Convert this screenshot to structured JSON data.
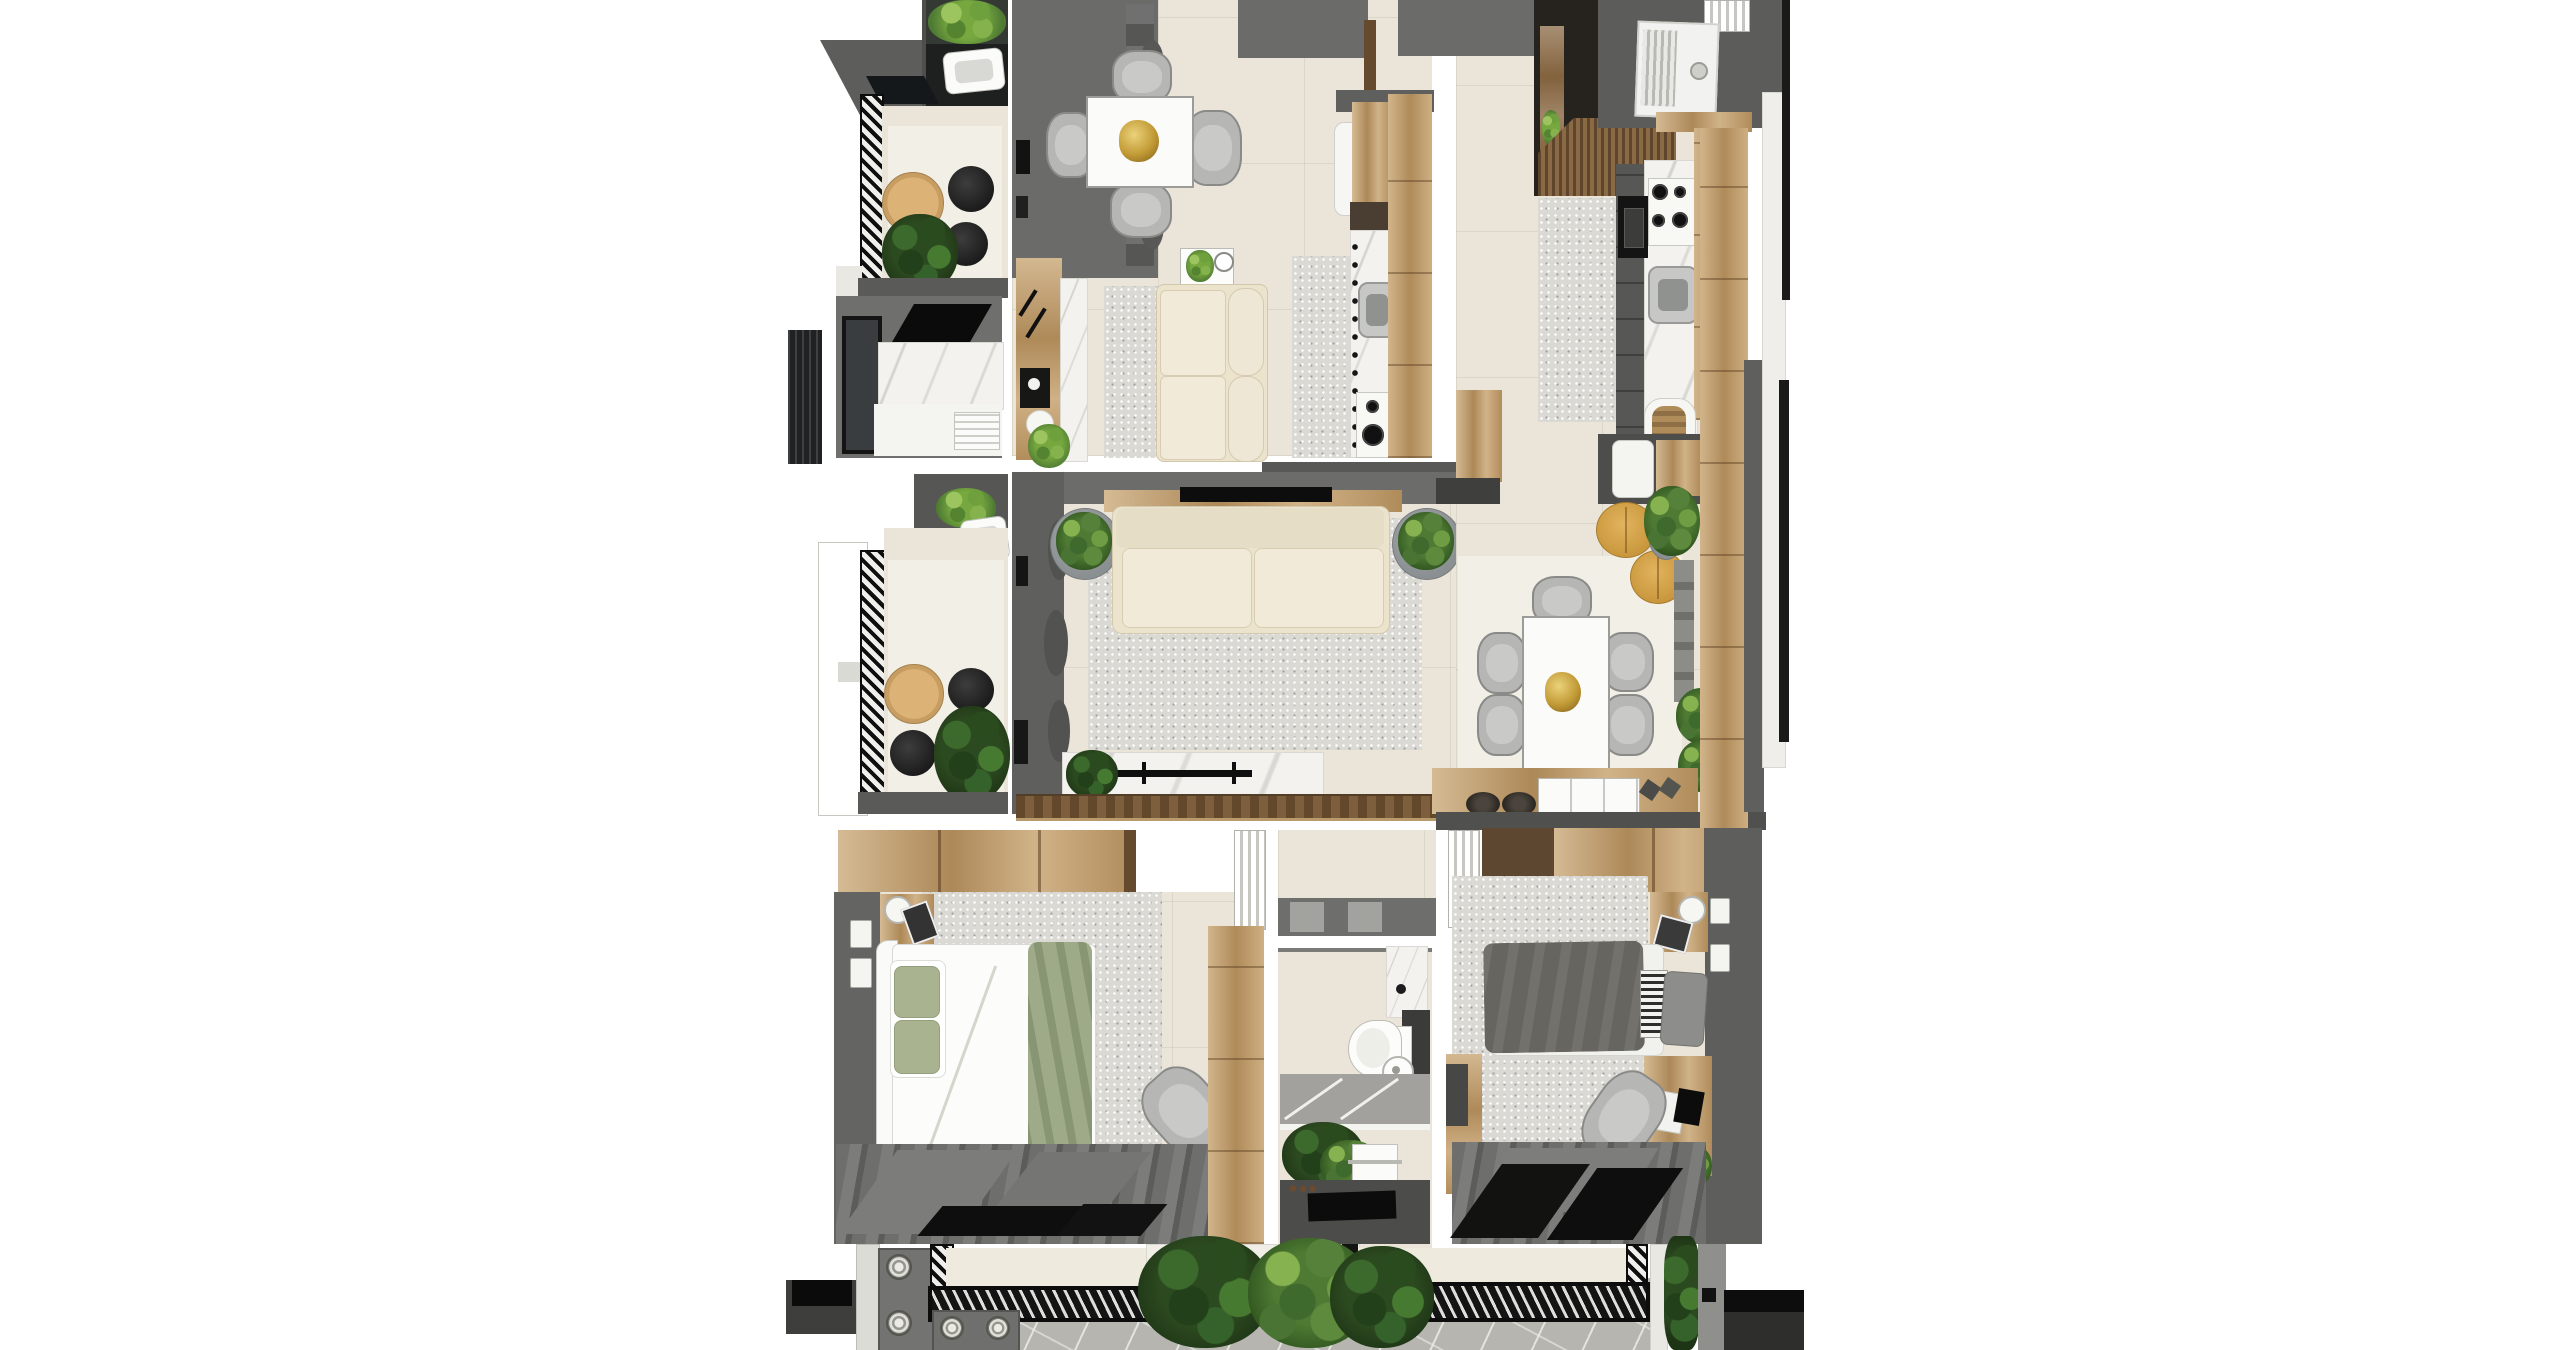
{
  "scene": {
    "type": "apartment floor plan - top-down 3D render",
    "view": "top-down",
    "has_text": false,
    "background": "#ffffff"
  },
  "palette": {
    "wall": "#6b6b69",
    "wallDark": "#535351",
    "wallDeep": "#3f3f3d",
    "floor": "#eae5d8",
    "floorLight": "#f2efe6",
    "rug": "#dad9d4",
    "wood": "#c5a06b",
    "woodDark": "#8a6a45",
    "woodDeep": "#654a2e",
    "marble": "#f3f2ee",
    "cream": "#ece3cd",
    "sage": "#a9b390",
    "duvet": "#67655f",
    "chair": "#b6b6b4",
    "gold": "#c49f3f",
    "mustard": "#d8a74e",
    "leaf": "#4e7a33",
    "leafDark": "#2c4a20",
    "stone": "#b6b5b0",
    "charcoal": "#131312"
  },
  "rooms": [
    {
      "name": "balcony-top-left",
      "furniture": [
        "planter",
        "outdoor-sink",
        "round-wood-table",
        "black-stools",
        "plant",
        "hatched-railing"
      ]
    },
    {
      "name": "laundry-room",
      "furniture": [
        "door",
        "marble-wall",
        "washer-counter",
        "ceiling-hatch",
        "ac-panel"
      ]
    },
    {
      "name": "balcony-middle-left",
      "furniture": [
        "white-door",
        "hatched-railing",
        "round-wood-table",
        "black-stools",
        "plant",
        "outdoor-sink"
      ]
    },
    {
      "name": "living-dining-a",
      "furniture": [
        "gray-wardrobe",
        "square-dining-table",
        "gold-bowl",
        "four-chairs",
        "coffee-table",
        "cream-sofa",
        "runner-rugs",
        "coffee-counter",
        "espresso-machine"
      ]
    },
    {
      "name": "kitchen-a",
      "furniture": [
        "fridge",
        "wood-cabinet",
        "marble-counter",
        "sink",
        "two-burner-stove",
        "wood-counter"
      ]
    },
    {
      "name": "living-room",
      "furniture": [
        "tv-wall-cabinet",
        "tv-console",
        "tv",
        "cream-sofa",
        "area-rug",
        "plant-pots",
        "marble-console",
        "towel-rail",
        "wood-deck"
      ]
    },
    {
      "name": "entry-hall-b",
      "furniture": [
        "dark-doorway",
        "wood-door",
        "slatted-awning",
        "washer-door",
        "wood-shelf"
      ]
    },
    {
      "name": "kitchen-b",
      "furniture": [
        "four-burner-stove",
        "microwave",
        "sink",
        "marble-counter",
        "wood-cabinet",
        "bread-box",
        "island-fridge",
        "rug"
      ]
    },
    {
      "name": "dining-b",
      "furniture": [
        "rect-dining-table",
        "gold-bowl",
        "five-chairs",
        "mustard-poufs",
        "plants",
        "sideboard",
        "white-drawers",
        "baskets"
      ]
    },
    {
      "name": "bedroom-left",
      "furniture": [
        "wood-wardrobe",
        "double-bed",
        "sage-pillows",
        "sage-throw",
        "nightstands",
        "lamp",
        "rug",
        "armchair",
        "plant",
        "dark-curtains",
        "louver-door",
        "tall-wardrobe"
      ]
    },
    {
      "name": "hallway-bath",
      "furniture": [
        "thresholds",
        "marble-shelf",
        "vanity",
        "toilet",
        "round-sink",
        "shower-floor",
        "monstera-plant",
        "towel",
        "black-mat"
      ]
    },
    {
      "name": "bedroom-right",
      "furniture": [
        "wood-wardrobe",
        "single-bed",
        "dark-duvet",
        "striped-pillow",
        "nightstand",
        "lamp",
        "desk",
        "laptop",
        "desk-chair",
        "rug",
        "plant",
        "dark-curtains",
        "louver-door",
        "dresser"
      ]
    },
    {
      "name": "terrace-bottom",
      "furniture": [
        "marble-pillar",
        "panel-doors",
        "rosettes",
        "hatched-strips",
        "slatted-grates",
        "stone-paving",
        "monstera-plants",
        "vine",
        "planter-boxes"
      ]
    }
  ]
}
